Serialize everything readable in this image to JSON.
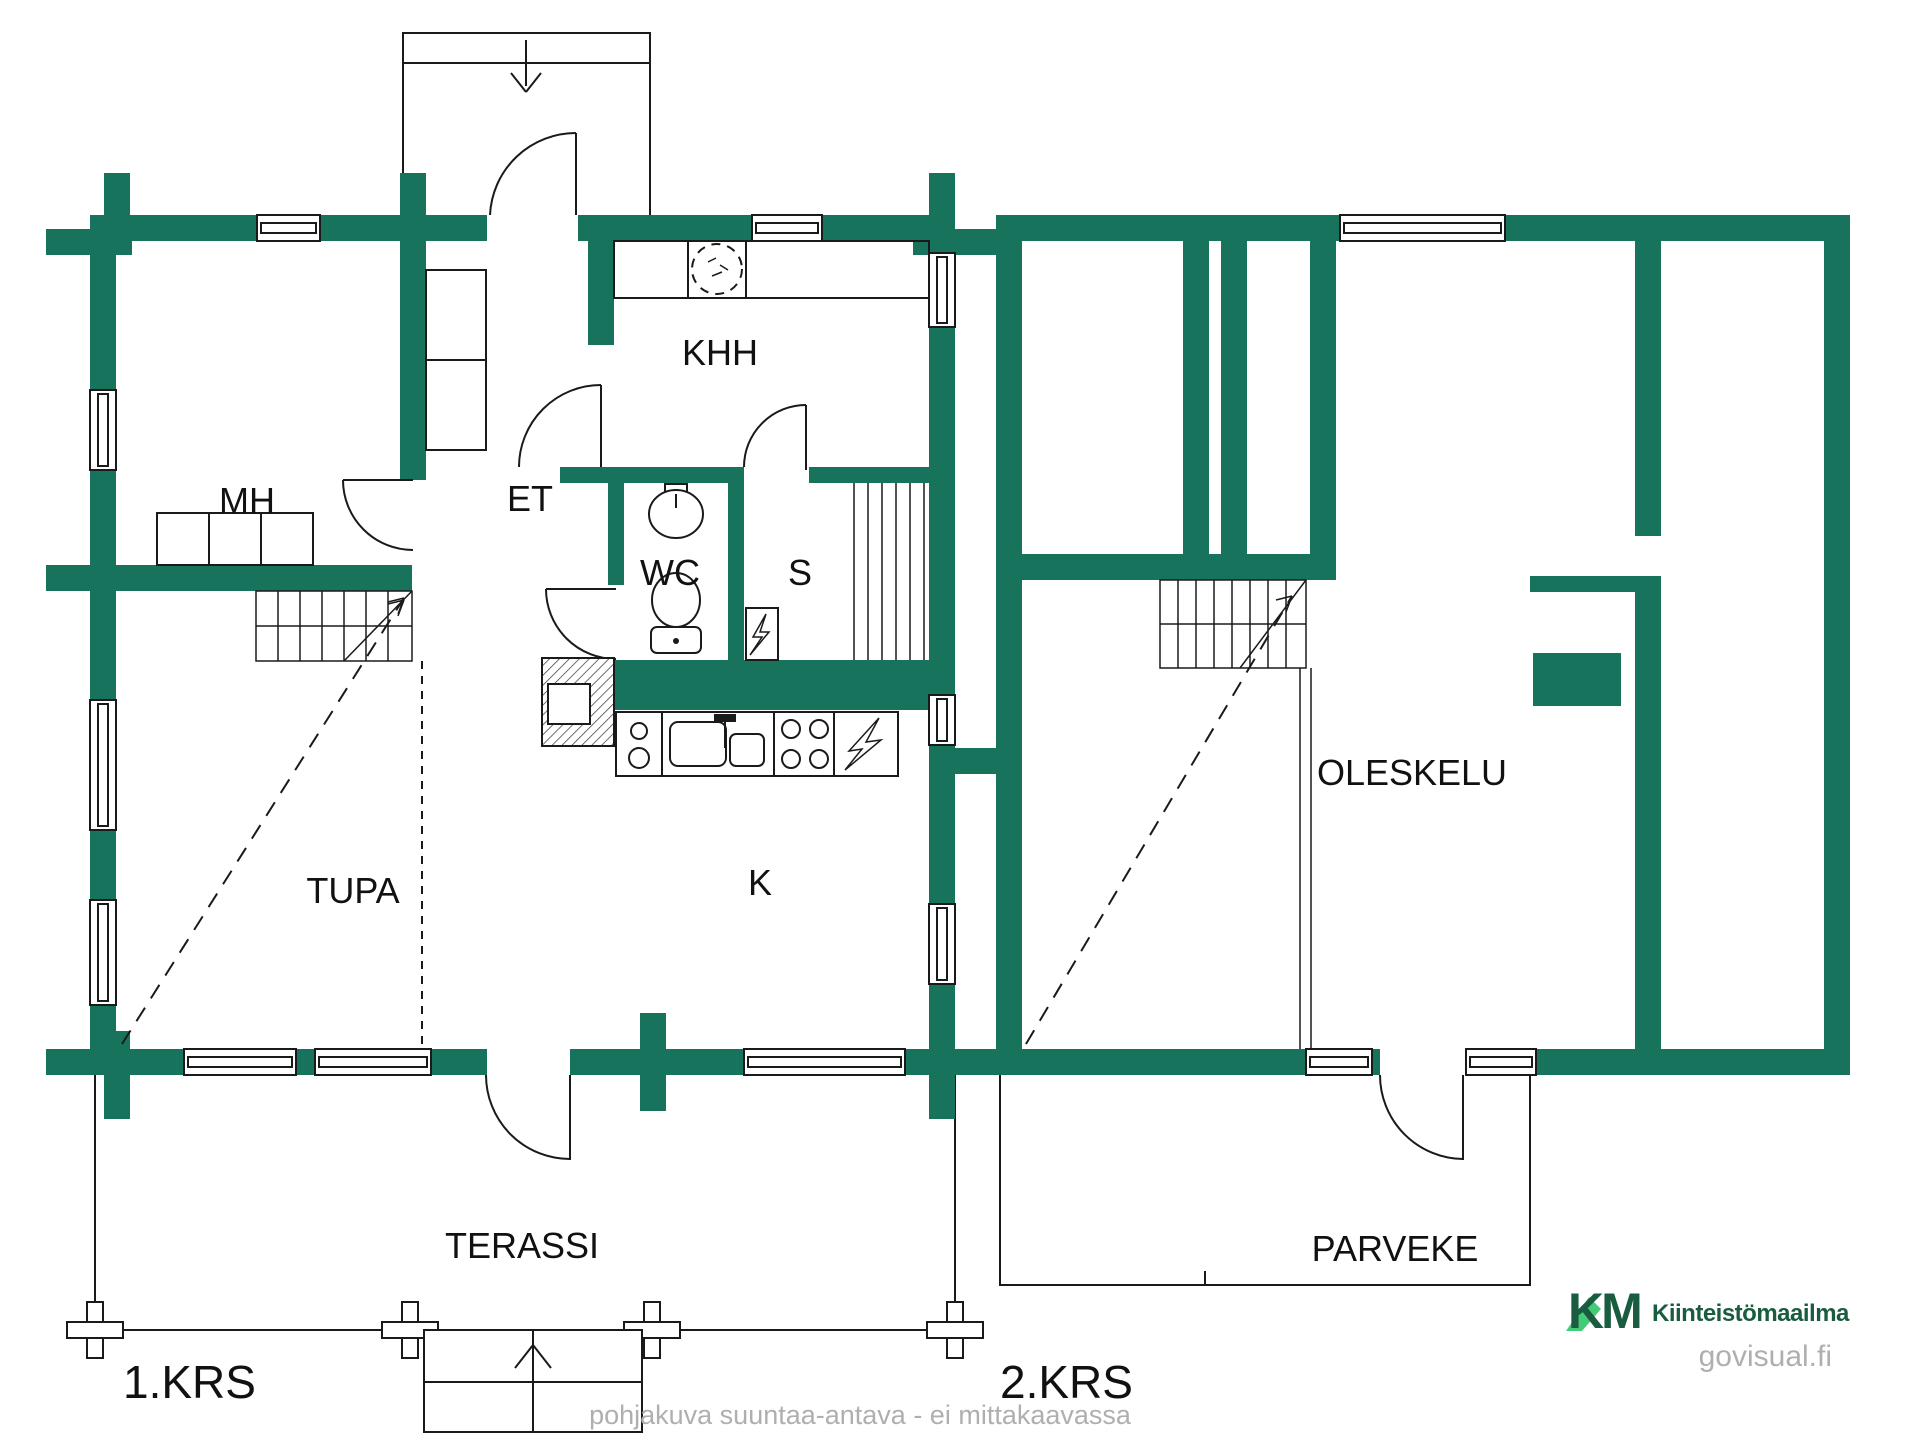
{
  "colors": {
    "wall": "#18735C",
    "line": "#1A1A1A",
    "brand_dark": "#1A5C40",
    "brand_light": "#45CB77",
    "muted_text": "#AEB0AF"
  },
  "floor1": {
    "label": "1.KRS",
    "rooms": [
      {
        "id": "mh",
        "label": "MH"
      },
      {
        "id": "et",
        "label": "ET"
      },
      {
        "id": "khh",
        "label": "KHH"
      },
      {
        "id": "wc",
        "label": "WC"
      },
      {
        "id": "s",
        "label": "S"
      },
      {
        "id": "k",
        "label": "K"
      },
      {
        "id": "tupa",
        "label": "TUPA"
      },
      {
        "id": "terassi",
        "label": "TERASSI"
      }
    ],
    "fixtures": [
      "bed",
      "wardrobe",
      "stairs",
      "fireplace",
      "washing-machine",
      "wc-sink",
      "toilet",
      "sauna-benches",
      "sauna-heater",
      "kitchen-sink",
      "stove",
      "refrigerator",
      "entry-steps",
      "terrace-steps"
    ]
  },
  "floor2": {
    "label": "2.KRS",
    "rooms": [
      {
        "id": "oleskelu",
        "label": "OLESKELU"
      },
      {
        "id": "parveke",
        "label": "PARVEKE"
      }
    ],
    "fixtures": [
      "stairs",
      "chimney",
      "railing"
    ]
  },
  "footer": {
    "disclaimer": "pohjakuva suuntaa-antava - ei mittakaavassa",
    "watermark": "govisual.fi"
  },
  "brand": {
    "initials": "KM",
    "name": "Kiinteistömaailma"
  }
}
